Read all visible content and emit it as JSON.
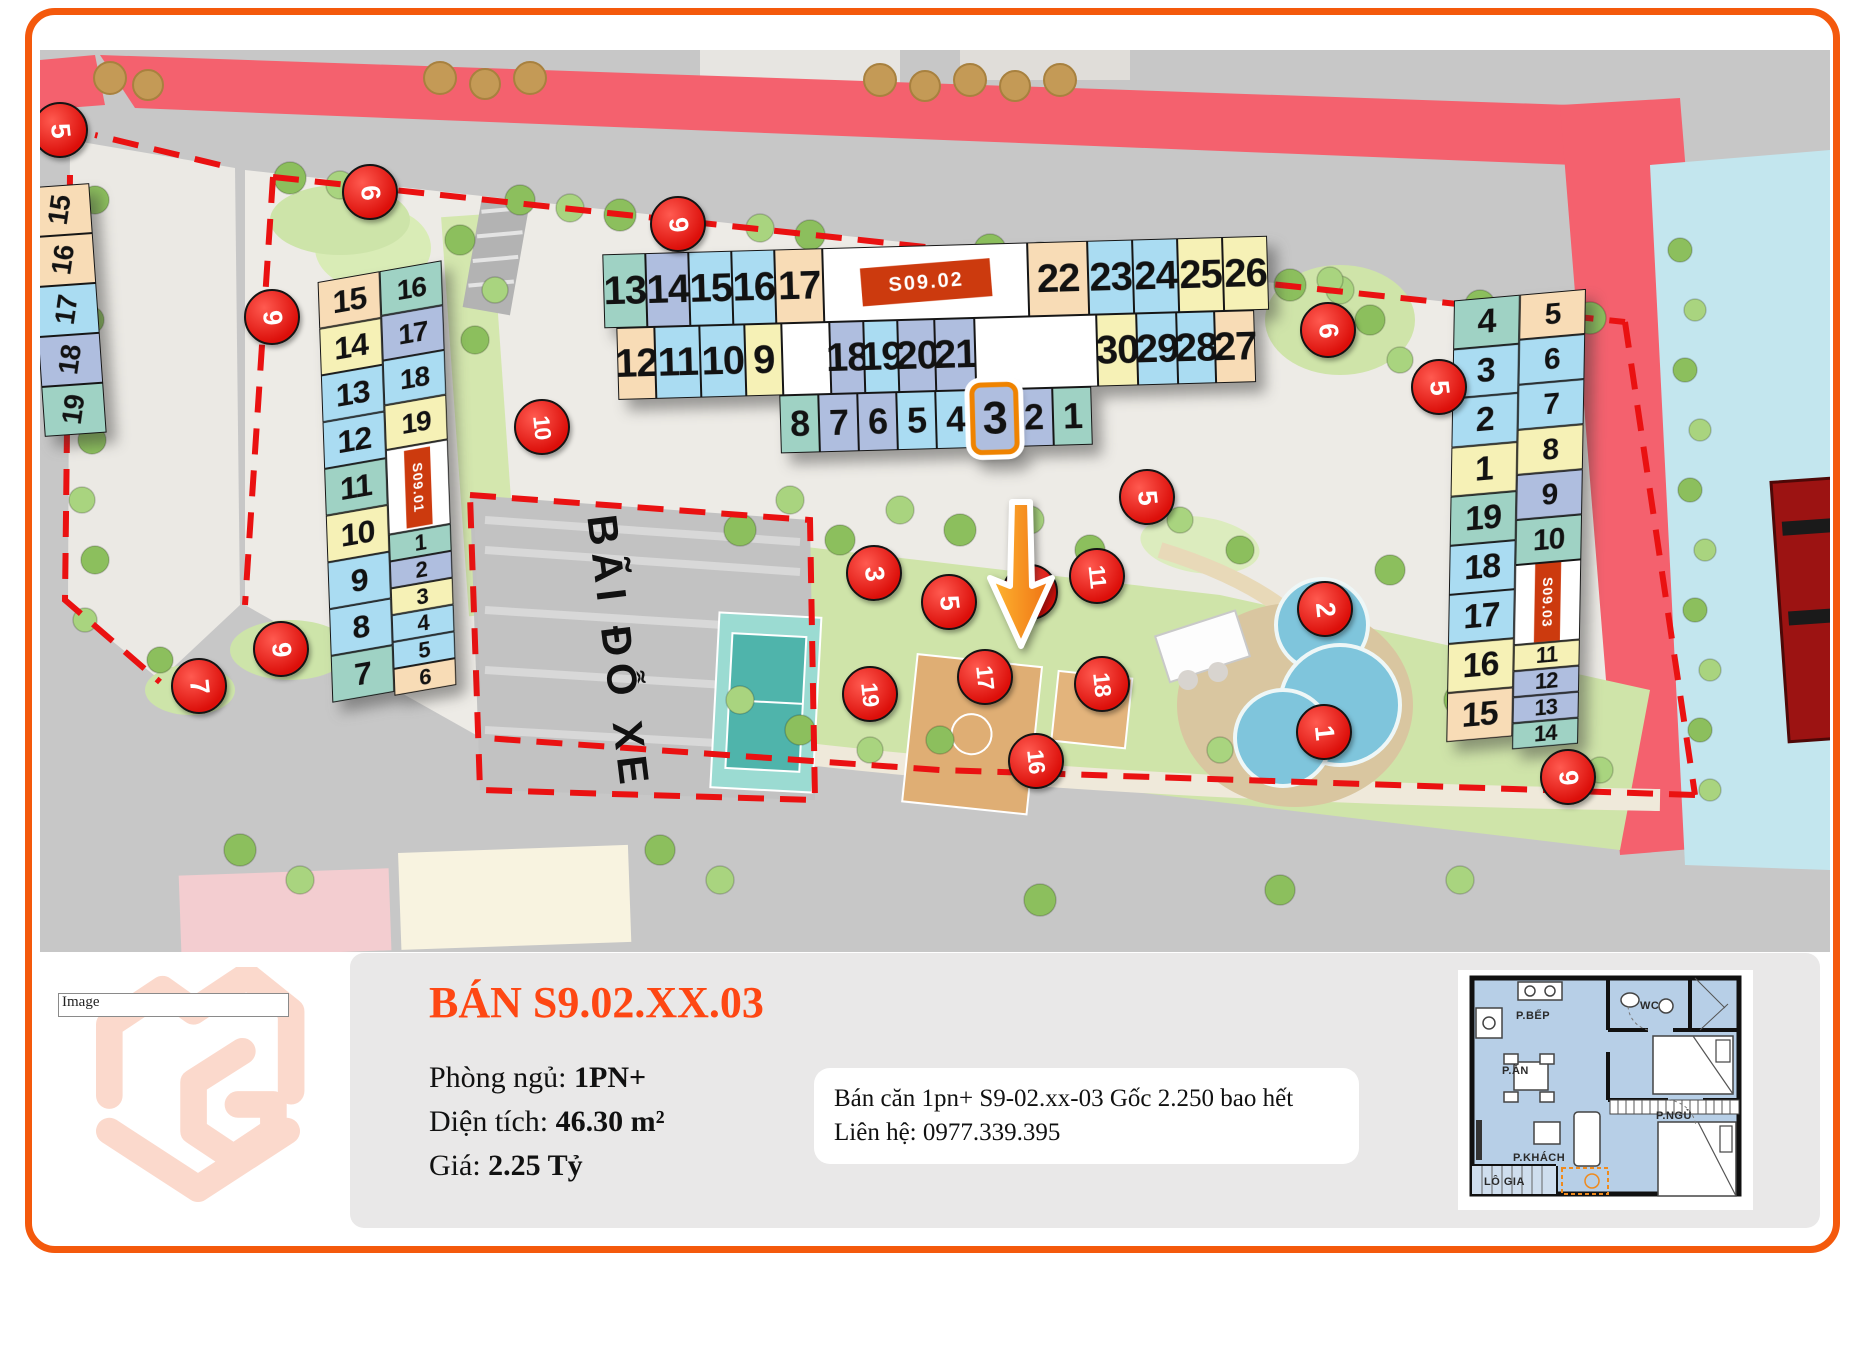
{
  "map": {
    "parking_label": "BÃI ĐỖ XE",
    "buildings": {
      "s0901": {
        "label": "S09.01",
        "left_column": [
          [
            "15",
            "peach"
          ],
          [
            "14",
            "yellow"
          ],
          [
            "13",
            "ltblue"
          ],
          [
            "12",
            "ltblue"
          ],
          [
            "11",
            "teal"
          ],
          [
            "10",
            "yellow"
          ],
          [
            "9",
            "ltblue"
          ],
          [
            "8",
            "ltblue"
          ],
          [
            "7",
            "teal"
          ]
        ],
        "right_column_top": [
          [
            "16",
            "teal"
          ],
          [
            "17",
            "peri"
          ],
          [
            "18",
            "ltblue"
          ],
          [
            "19",
            "yellow"
          ]
        ],
        "right_column_bottom": [
          [
            "1",
            "teal"
          ],
          [
            "2",
            "peri"
          ],
          [
            "3",
            "yellow"
          ],
          [
            "4",
            "ltblue"
          ],
          [
            "5",
            "ltblue"
          ],
          [
            "6",
            "peach"
          ]
        ]
      },
      "s0902": {
        "label": "S09.02",
        "highlighted_unit": "3",
        "row1_left": [
          [
            "13",
            "teal"
          ],
          [
            "14",
            "peri"
          ],
          [
            "15",
            "ltblue"
          ],
          [
            "16",
            "ltblue"
          ],
          [
            "17",
            "peach"
          ]
        ],
        "row1_right": [
          [
            "22",
            "peach"
          ],
          [
            "23",
            "ltblue"
          ],
          [
            "24",
            "ltblue"
          ],
          [
            "25",
            "yellow"
          ],
          [
            "26",
            "yellow"
          ]
        ],
        "row2_left": [
          [
            "12",
            "peach"
          ],
          [
            "11",
            "ltblue"
          ],
          [
            "10",
            "ltblue"
          ],
          [
            "9",
            "yellow"
          ]
        ],
        "row2_mid": [
          [
            "18",
            "peri"
          ],
          [
            "19",
            "ltblue"
          ],
          [
            "20",
            "peri"
          ],
          [
            "21",
            "peri"
          ]
        ],
        "row2_right": [
          [
            "30",
            "yellow"
          ],
          [
            "29",
            "ltblue"
          ],
          [
            "28",
            "ltblue"
          ],
          [
            "27",
            "peach"
          ]
        ],
        "row3": [
          [
            "8",
            "teal"
          ],
          [
            "7",
            "peri"
          ],
          [
            "6",
            "peri"
          ],
          [
            "5",
            "ltblue"
          ],
          [
            "4",
            "ltblue"
          ],
          [
            "3",
            "peri"
          ],
          [
            "2",
            "peri"
          ],
          [
            "1",
            "teal"
          ]
        ]
      },
      "s0903": {
        "label": "S09.03",
        "left_column": [
          [
            "4",
            "teal"
          ],
          [
            "3",
            "ltblue"
          ],
          [
            "2",
            "ltblue"
          ],
          [
            "1",
            "yellow"
          ],
          [
            "19",
            "teal"
          ],
          [
            "18",
            "ltblue"
          ],
          [
            "17",
            "ltblue"
          ],
          [
            "16",
            "yellow"
          ],
          [
            "15",
            "peach"
          ]
        ],
        "right_column_top": [
          [
            "5",
            "peach"
          ],
          [
            "6",
            "ltblue"
          ],
          [
            "7",
            "ltblue"
          ],
          [
            "8",
            "yellow"
          ],
          [
            "9",
            "peri"
          ],
          [
            "10",
            "teal"
          ]
        ],
        "right_column_bottom": [
          [
            "11",
            "yellow"
          ],
          [
            "12",
            "peri"
          ],
          [
            "13",
            "peri"
          ],
          [
            "14",
            "teal"
          ]
        ]
      },
      "edge_partial": {
        "units": [
          [
            "15",
            "peach"
          ],
          [
            "16",
            "peach"
          ],
          [
            "17",
            "ltblue"
          ],
          [
            "18",
            "peri"
          ],
          [
            "19",
            "teal"
          ]
        ]
      }
    },
    "markers": [
      {
        "n": "5",
        "x": 18,
        "y": 78
      },
      {
        "n": "6",
        "x": 328,
        "y": 140
      },
      {
        "n": "9",
        "x": 230,
        "y": 265
      },
      {
        "n": "9",
        "x": 636,
        "y": 172
      },
      {
        "n": "10",
        "x": 500,
        "y": 375
      },
      {
        "n": "6",
        "x": 1286,
        "y": 278
      },
      {
        "n": "5",
        "x": 1397,
        "y": 335
      },
      {
        "n": "5",
        "x": 1105,
        "y": 445
      },
      {
        "n": "3",
        "x": 832,
        "y": 521
      },
      {
        "n": "5",
        "x": 907,
        "y": 550
      },
      {
        "n": "4",
        "x": 988,
        "y": 540
      },
      {
        "n": "11",
        "x": 1055,
        "y": 524
      },
      {
        "n": "2",
        "x": 1283,
        "y": 557
      },
      {
        "n": "1",
        "x": 1282,
        "y": 680
      },
      {
        "n": "19",
        "x": 828,
        "y": 642
      },
      {
        "n": "17",
        "x": 943,
        "y": 625
      },
      {
        "n": "18",
        "x": 1060,
        "y": 632
      },
      {
        "n": "16",
        "x": 994,
        "y": 709
      },
      {
        "n": "9",
        "x": 239,
        "y": 597
      },
      {
        "n": "7",
        "x": 157,
        "y": 634
      },
      {
        "n": "9",
        "x": 1526,
        "y": 725
      }
    ]
  },
  "panel": {
    "logo_alt": "Image",
    "title": "BÁN S9.02.XX.03",
    "fields": [
      {
        "label": "Phòng ngủ: ",
        "value": "1PN+"
      },
      {
        "label": "Diện tích: ",
        "value": "46.30 m²"
      },
      {
        "label": "Giá: ",
        "value": "2.25 Tỷ"
      }
    ],
    "note": "Bán căn 1pn+ S9-02.xx-03 Gốc 2.250 bao hết Liên hệ: 0977.339.395"
  },
  "floorplan": {
    "labels": [
      {
        "t": "P.BẾP",
        "x": 58,
        "y": 40
      },
      {
        "t": "WC",
        "x": 182,
        "y": 30
      },
      {
        "t": "P.ĂN",
        "x": 44,
        "y": 95
      },
      {
        "t": "P.NGỦ",
        "x": 198,
        "y": 140
      },
      {
        "t": "P.KHÁCH",
        "x": 55,
        "y": 182
      },
      {
        "t": "LÔ GIA",
        "x": 26,
        "y": 206
      }
    ]
  },
  "colors": {
    "frame": "#f4590c",
    "accent": "#fe4713",
    "marker_red": "#e01310",
    "highlight": "#ef8300",
    "road_pink": "#f4616e",
    "cells": {
      "teal": "#9fd2c4",
      "ltblue": "#aadcf2",
      "peri": "#afbedf",
      "yellow": "#f6f1b6",
      "peach": "#f8dcb6",
      "white": "#ffffff"
    }
  }
}
